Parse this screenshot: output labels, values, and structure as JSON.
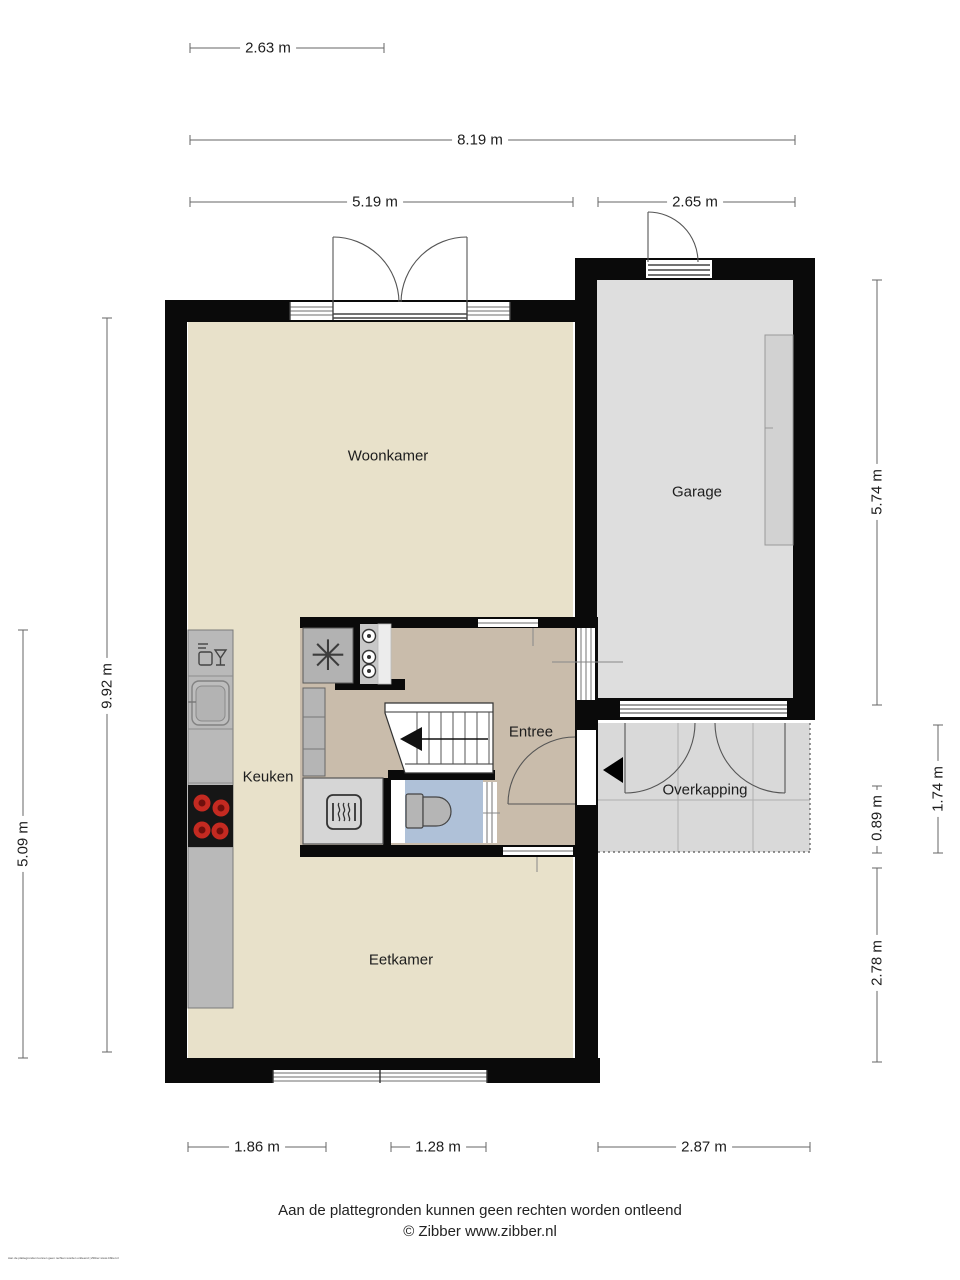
{
  "plan": {
    "rooms": [
      {
        "id": "woonkamer",
        "label": "Woonkamer"
      },
      {
        "id": "garage",
        "label": "Garage"
      },
      {
        "id": "keuken",
        "label": "Keuken"
      },
      {
        "id": "entree",
        "label": "Entree"
      },
      {
        "id": "overkapping",
        "label": "Overkapping"
      },
      {
        "id": "eetkamer",
        "label": "Eetkamer"
      }
    ],
    "dimensions": {
      "top": [
        {
          "label": "2.63 m"
        },
        {
          "label": "8.19 m"
        },
        {
          "label": "5.19 m"
        },
        {
          "label": "2.65 m"
        }
      ],
      "left": [
        {
          "label": "9.92 m"
        },
        {
          "label": "5.09 m"
        }
      ],
      "right": [
        {
          "label": "5.74 m"
        },
        {
          "label": "1.74 m"
        },
        {
          "label": "0.89 m"
        },
        {
          "label": "2.78 m"
        }
      ],
      "bottom": [
        {
          "label": "1.86 m"
        },
        {
          "label": "1.28 m"
        },
        {
          "label": "2.87 m"
        }
      ]
    },
    "footer": {
      "disclaimer": "Aan de plattegronden kunnen geen rechten worden ontleend",
      "copyright": "© Zibber www.zibber.nl",
      "micro": "Aan de plattegronden kunnen geen rechten worden ontleend | Zibber www.zibber.nl"
    },
    "icons": {
      "fan": "✳"
    },
    "colors": {
      "floor_main": "#e8e1ca",
      "floor_entree": "#c9bcab",
      "floor_garage": "#dedede",
      "floor_overkapping": "#d9d9d9",
      "floor_toilet": "#afc1d8",
      "wall": "#0a0a0a",
      "counter": "#b9b9b9",
      "fixture": "#b5b5b5",
      "burner": "#c42a21",
      "dim_line": "#666666"
    }
  }
}
